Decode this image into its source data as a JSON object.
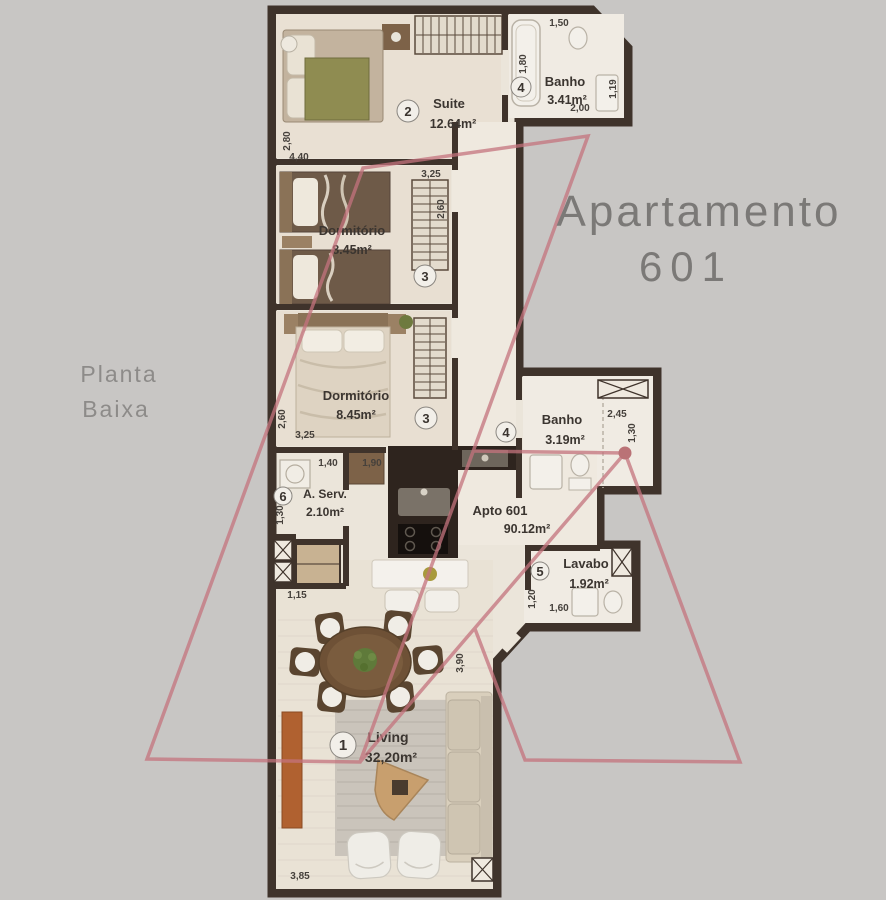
{
  "title": {
    "line1": "Apartamento",
    "line2": "601"
  },
  "subtitle": {
    "line1": "Planta",
    "line2": "Baixa"
  },
  "apto": {
    "name": "Apto 601",
    "area": "90.12m²"
  },
  "rooms": {
    "living": {
      "number": "1",
      "name": "Living",
      "area": "32,20m²"
    },
    "suite": {
      "number": "2",
      "name": "Suite",
      "area": "12.64m²"
    },
    "dorm1": {
      "number": "3",
      "name": "Dormitório",
      "area": "8.45m²"
    },
    "dorm2": {
      "number": "3",
      "name": "Dormitório",
      "area": "8.45m²"
    },
    "banho_suite": {
      "number": "4",
      "name": "Banho",
      "area": "3.41m²"
    },
    "banho_social": {
      "number": "4",
      "name": "Banho",
      "area": "3.19m²"
    },
    "lavabo": {
      "number": "5",
      "name": "Lavabo",
      "area": "1.92m²"
    },
    "servico": {
      "number": "6",
      "name": "A. Serv.",
      "area": "2.10m²"
    }
  },
  "dimensions": {
    "suite_height": "2,80",
    "suite_width": "4,40",
    "banho_suite_top": "1,50",
    "banho_suite_left": "1,80",
    "banho_suite_width": "2,00",
    "banho_suite_right": "1,19",
    "dorm1_closet_width": "3,25",
    "dorm1_closet_height": "2,60",
    "dorm2_height": "2,60",
    "dorm2_width": "3,25",
    "servico_top": "1,40",
    "kitchen_top": "1,90",
    "servico_left": "1,30",
    "hall_width": "1,15",
    "banho_social_width": "2,45",
    "banho_social_height": "1,30",
    "lavabo_height": "1,20",
    "lavabo_width": "1,60",
    "living_height": "3,90",
    "living_width": "3,85"
  },
  "colors": {
    "background": "#c8c6c4",
    "wall": "#3f332b",
    "floor": "#ebe5da",
    "watermark": "#c4737d",
    "watermark_dot": "#a84a52",
    "title": "#7b7977"
  }
}
